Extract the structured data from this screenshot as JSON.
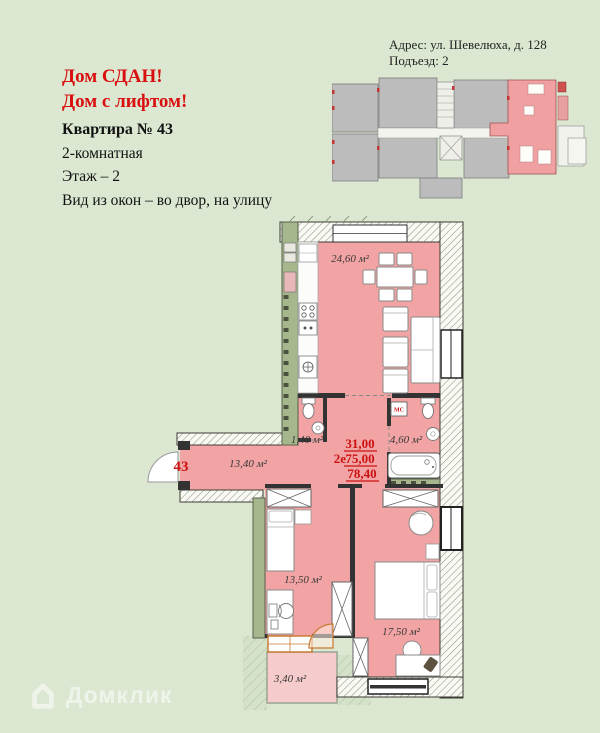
{
  "page": {
    "background_color": "#dbe7d1"
  },
  "promo": {
    "line1": "Дом СДАН!",
    "line2": "Дом с лифтом!",
    "color": "#d90f0f"
  },
  "address": {
    "line1": "Адрес: ул. Шевелюха, д. 128",
    "line2": "Подъезд: 2"
  },
  "apartment": {
    "title": "Квартира № 43",
    "details": [
      "2-комнатная",
      "Этаж – 2",
      "Вид из окон – во двор, на улицу"
    ],
    "number": "43"
  },
  "floorplan": {
    "room_labels": {
      "living": "24,60 м²",
      "wc": "1,40 м²",
      "bathroom": "4,60 м²",
      "hallway": "13,40 м²",
      "bedroom1": "13,50 м²",
      "bedroom2": "17,50 м²",
      "balcony": "3,40 м²"
    },
    "area_summary": {
      "living_area": "31,00",
      "plan_type": "2е",
      "total_area": "75,00",
      "total_with_balcony": "78,40"
    },
    "appliance_labels": {
      "washing_machine": "МС"
    },
    "colors": {
      "room_fill": "#f2a3a3",
      "balcony_fill": "#f5cbcb",
      "wall_green": "#a6b78d",
      "accent_red": "#cc1111",
      "door_orange": "#c87a33"
    }
  },
  "watermark": {
    "text": "Домклик",
    "logo": "house-icon"
  }
}
